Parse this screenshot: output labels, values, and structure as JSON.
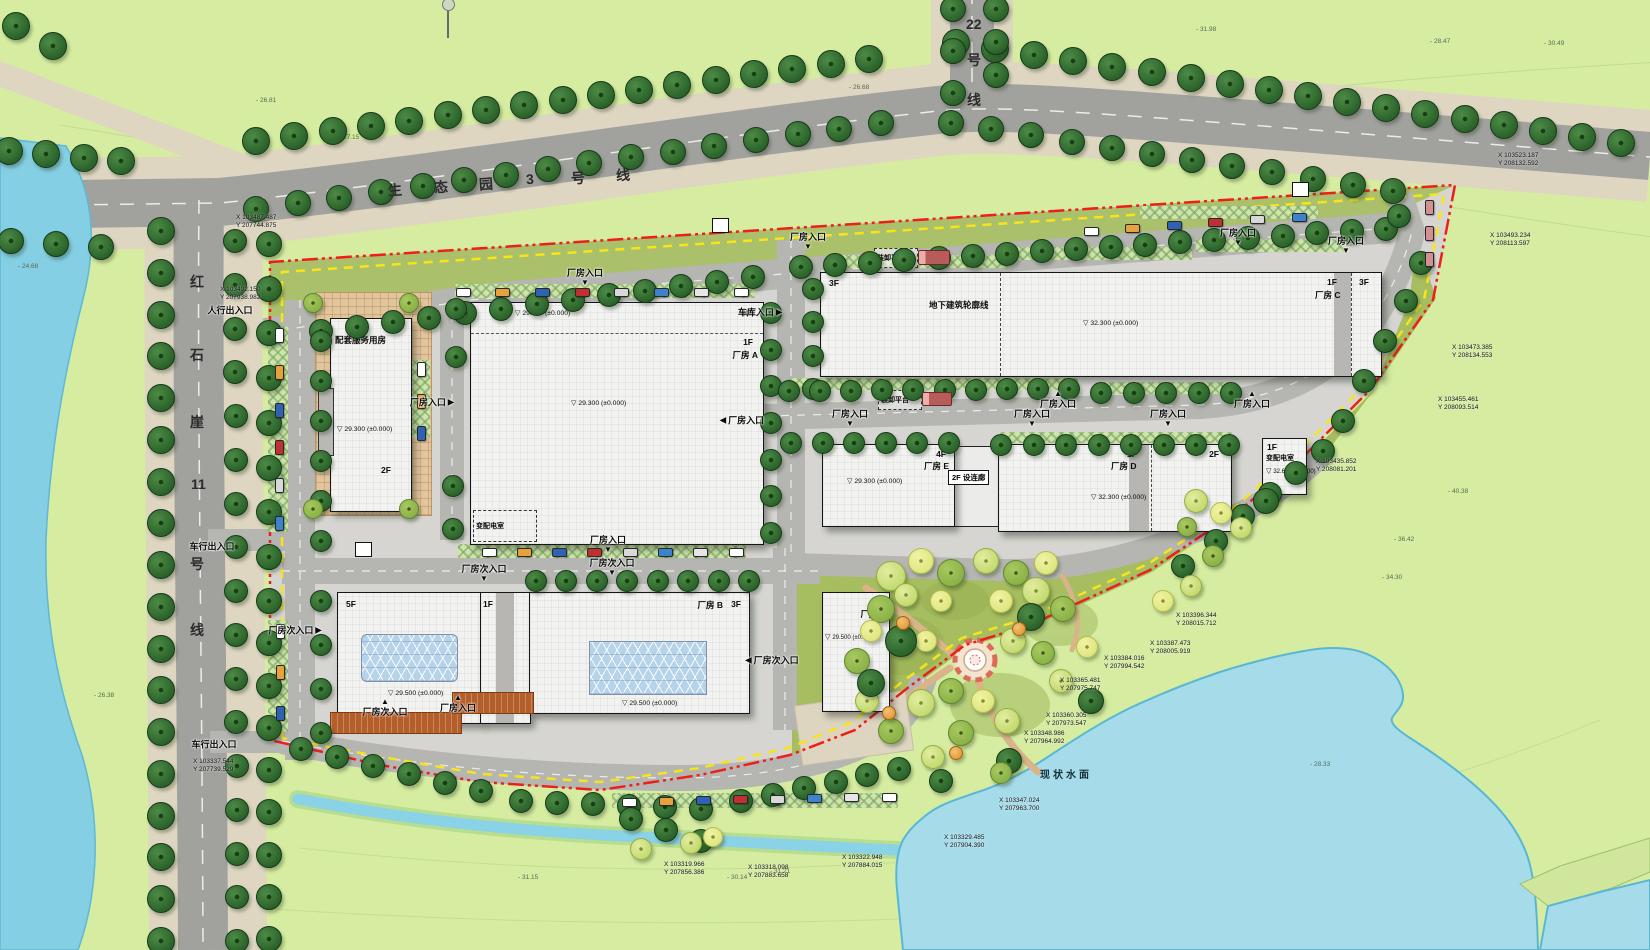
{
  "site": {
    "water_label": "现状水面",
    "water_pos": {
      "x": 1040,
      "y": 766
    }
  },
  "road_labels": {
    "eco_park_line3": {
      "text": "生态园3号线",
      "rotate": -4,
      "tokens": [
        {
          "c": "生",
          "x": 388,
          "y": 180
        },
        {
          "c": "态",
          "x": 434,
          "y": 177
        },
        {
          "c": "园",
          "x": 479,
          "y": 174
        },
        {
          "c": "3",
          "x": 526,
          "y": 171
        },
        {
          "c": "号",
          "x": 571,
          "y": 168
        },
        {
          "c": "线",
          "x": 616,
          "y": 165
        }
      ]
    },
    "line22": {
      "text": "22号线",
      "tokens": [
        {
          "c": "22",
          "x": 966,
          "y": 16
        },
        {
          "c": "号",
          "x": 967,
          "y": 50
        },
        {
          "c": "线",
          "x": 967,
          "y": 90
        }
      ]
    },
    "hongshiya_line11": {
      "text": "红石崖11号线",
      "tokens": [
        {
          "c": "红",
          "x": 190,
          "y": 272
        },
        {
          "c": "石",
          "x": 190,
          "y": 345
        },
        {
          "c": "崖",
          "x": 190,
          "y": 412
        },
        {
          "c": "11",
          "x": 191,
          "y": 476
        },
        {
          "c": "号",
          "x": 190,
          "y": 554
        },
        {
          "c": "线",
          "x": 190,
          "y": 620
        }
      ]
    }
  },
  "buildings": {
    "service": {
      "floors": "3F",
      "name": "配套服务用房",
      "elev": "29.300 (±0.000)",
      "floors2": "2F"
    },
    "a": {
      "elev_top": "29.300 (±0.000)",
      "floors": "3F",
      "floors_wing": "1F",
      "name": "厂房 A",
      "elev": "29.300 (±0.000)",
      "substation": "变配电室"
    },
    "c": {
      "floors_left": "3F",
      "underground": "地下建筑轮廓线",
      "elev": "32.300 (±0.000)",
      "floors_mid": "1F",
      "name": "厂房 C",
      "floors_right": "3F"
    },
    "e": {
      "floors": "4F",
      "name": "厂房 E",
      "elev": "29.300 (±0.000)"
    },
    "corridor": {
      "label": "2F 设连廊"
    },
    "d": {
      "floors": "1F",
      "name": "厂房 D",
      "floors2": "2F",
      "elev": "32.300 (±0.000)"
    },
    "sub_right": {
      "floors": "1F",
      "name": "变配电室",
      "elev": "32.600 (±0.000)"
    },
    "b5f": {
      "floors": "5F",
      "elev": "29.500 (±0.000)"
    },
    "b_wing": {
      "floors": "1F"
    },
    "b": {
      "name": "厂房 B",
      "floors": "3F",
      "elev": "29.500 (±0.000)"
    },
    "f": {
      "floors": "2F",
      "name": "厂房 F",
      "elev": "29.500 (±0.000)"
    }
  },
  "annotations": {
    "platform": "装卸平台"
  },
  "entrances": [
    {
      "t": "厂房入口",
      "d": "down",
      "x": 585,
      "y": 276
    },
    {
      "t": "厂房入口",
      "d": "right",
      "x": 432,
      "y": 402
    },
    {
      "t": "车库入口",
      "d": "right",
      "x": 760,
      "y": 312
    },
    {
      "t": "厂房入口",
      "d": "down",
      "x": 808,
      "y": 240
    },
    {
      "t": "厂房入口",
      "d": "down",
      "x": 1238,
      "y": 236
    },
    {
      "t": "厂房入口",
      "d": "down",
      "x": 1346,
      "y": 244
    },
    {
      "t": "厂房入口",
      "d": "left",
      "x": 742,
      "y": 420
    },
    {
      "t": "厂房入口",
      "d": "down",
      "x": 850,
      "y": 417
    },
    {
      "t": "厂房入口",
      "d": "up",
      "x": 1058,
      "y": 400
    },
    {
      "t": "厂房入口",
      "d": "down",
      "x": 1032,
      "y": 417
    },
    {
      "t": "厂房入口",
      "d": "down",
      "x": 1168,
      "y": 417
    },
    {
      "t": "厂房入口",
      "d": "up",
      "x": 1252,
      "y": 400
    },
    {
      "t": "厂房入口",
      "d": "down",
      "x": 608,
      "y": 543
    },
    {
      "t": "厂房次入口",
      "d": "down",
      "x": 484,
      "y": 572
    },
    {
      "t": "厂房次入口",
      "d": "down",
      "x": 612,
      "y": 566
    },
    {
      "t": "厂房次入口",
      "d": "right",
      "x": 295,
      "y": 630
    },
    {
      "t": "厂房次入口",
      "d": "left",
      "x": 772,
      "y": 660
    },
    {
      "t": "厂房次入口",
      "d": "up",
      "x": 385,
      "y": 708
    },
    {
      "t": "厂房入口",
      "d": "up",
      "x": 458,
      "y": 704
    },
    {
      "t": "人行出入口",
      "d": "none",
      "x": 230,
      "y": 310
    },
    {
      "t": "车行出入口",
      "d": "none",
      "x": 212,
      "y": 546
    },
    {
      "t": "车行出入口",
      "d": "none",
      "x": 214,
      "y": 744
    }
  ],
  "coordinates": [
    {
      "x": "103487.487",
      "y": "207744.875",
      "px": 236,
      "py": 214
    },
    {
      "x": "103492.150",
      "y": "207938.982",
      "px": 220,
      "py": 286
    },
    {
      "x": "103523.187",
      "y": "208132.592",
      "px": 1498,
      "py": 152
    },
    {
      "x": "103493.234",
      "y": "208113.597",
      "px": 1490,
      "py": 232
    },
    {
      "x": "103473.385",
      "y": "208134.553",
      "px": 1452,
      "py": 344
    },
    {
      "x": "103455.461",
      "y": "208093.514",
      "px": 1438,
      "py": 396
    },
    {
      "x": "103435.852",
      "y": "208081.201",
      "px": 1316,
      "py": 458
    },
    {
      "x": "103396.344",
      "y": "208015.712",
      "px": 1176,
      "py": 612
    },
    {
      "x": "103387.473",
      "y": "208005.919",
      "px": 1150,
      "py": 640
    },
    {
      "x": "103384.016",
      "y": "207994.542",
      "px": 1104,
      "py": 655
    },
    {
      "x": "103365.481",
      "y": "207975.747",
      "px": 1060,
      "py": 677
    },
    {
      "x": "103360.305",
      "y": "207973.547",
      "px": 1046,
      "py": 712
    },
    {
      "x": "103348.986",
      "y": "207964.992",
      "px": 1024,
      "py": 730
    },
    {
      "x": "103347.024",
      "y": "207963.700",
      "px": 999,
      "py": 797
    },
    {
      "x": "103329.485",
      "y": "207904.390",
      "px": 944,
      "py": 834
    },
    {
      "x": "103322.948",
      "y": "207884.015",
      "px": 842,
      "py": 854
    },
    {
      "x": "103318.098",
      "y": "207883.658",
      "px": 748,
      "py": 864
    },
    {
      "x": "103319.966",
      "y": "207856.386",
      "px": 664,
      "py": 861
    },
    {
      "x": "103337.544",
      "y": "207739.529",
      "px": 193,
      "py": 758
    }
  ],
  "spot_elevations": [
    {
      "t": "26.81",
      "x": 256,
      "y": 97
    },
    {
      "t": "27.15",
      "x": 339,
      "y": 134
    },
    {
      "t": "26.68",
      "x": 849,
      "y": 84
    },
    {
      "t": "31.98",
      "x": 1196,
      "y": 26
    },
    {
      "t": "28.47",
      "x": 1430,
      "y": 38
    },
    {
      "t": "30.49",
      "x": 1544,
      "y": 40
    },
    {
      "t": "24.68",
      "x": 18,
      "y": 263
    },
    {
      "t": "26.38",
      "x": 94,
      "y": 692
    },
    {
      "t": "28.33",
      "x": 1310,
      "y": 761
    },
    {
      "t": "31.21",
      "x": 770,
      "y": 868
    },
    {
      "t": "30.14",
      "x": 727,
      "y": 874
    },
    {
      "t": "31.15",
      "x": 518,
      "y": 874
    },
    {
      "t": "40.38",
      "x": 1448,
      "y": 488
    },
    {
      "t": "36.42",
      "x": 1394,
      "y": 536
    },
    {
      "t": "34.30",
      "x": 1382,
      "y": 574
    }
  ],
  "colors": {
    "boundary_red": "#ee1f1b",
    "boundary_yellow": "#f7e51c",
    "water": "#a6dcea",
    "river": "#84cfe3",
    "lawn": "#d5eca1",
    "garden": "#a6bd60",
    "road": "#a1a19e",
    "sidewalk": "#ded6c1",
    "building": "#f2f2f0"
  },
  "decor": {
    "tree_rows": [
      [
        8,
        150,
        120,
        160,
        4,
        13
      ],
      [
        10,
        240,
        100,
        246,
        3,
        12
      ],
      [
        255,
        140,
        868,
        58,
        17,
        13
      ],
      [
        955,
        42,
        1620,
        142,
        18,
        13
      ],
      [
        255,
        208,
        880,
        122,
        16,
        12
      ],
      [
        950,
        122,
        1392,
        190,
        12,
        12
      ],
      [
        952,
        8,
        952,
        92,
        3,
        12
      ],
      [
        995,
        8,
        995,
        74,
        3,
        12
      ],
      [
        160,
        230,
        160,
        940,
        18,
        13
      ],
      [
        234,
        240,
        236,
        940,
        17,
        11
      ],
      [
        268,
        243,
        268,
        556,
        8,
        12
      ],
      [
        268,
        600,
        268,
        938,
        9,
        12
      ],
      [
        320,
        330,
        752,
        276,
        13,
        11
      ],
      [
        800,
        266,
        1385,
        228,
        18,
        11
      ],
      [
        770,
        312,
        770,
        532,
        7,
        10
      ],
      [
        812,
        288,
        812,
        388,
        4,
        10
      ],
      [
        788,
        390,
        1068,
        388,
        10,
        10
      ],
      [
        1100,
        392,
        1230,
        392,
        5,
        10
      ],
      [
        790,
        442,
        948,
        442,
        6,
        10
      ],
      [
        1000,
        444,
        1228,
        444,
        8,
        10
      ],
      [
        535,
        580,
        748,
        580,
        8,
        10
      ],
      [
        320,
        340,
        320,
        540,
        6,
        10
      ],
      [
        320,
        600,
        320,
        732,
        4,
        10
      ],
      [
        300,
        748,
        480,
        790,
        6,
        11
      ],
      [
        520,
        800,
        700,
        808,
        6,
        11
      ],
      [
        740,
        800,
        898,
        768,
        6,
        11
      ],
      [
        1398,
        215,
        1420,
        262,
        2,
        11
      ],
      [
        1405,
        300,
        1342,
        420,
        4,
        11
      ],
      [
        1322,
        450,
        1242,
        515,
        4,
        11
      ],
      [
        1215,
        540,
        1182,
        565,
        2,
        11
      ],
      [
        452,
        485,
        452,
        528,
        2,
        10
      ],
      [
        455,
        308,
        455,
        356,
        2,
        10
      ],
      [
        630,
        818,
        700,
        840,
        3,
        11
      ],
      [
        15,
        25,
        52,
        45,
        2,
        13
      ]
    ],
    "tree_singles": [
      [
        890,
        575,
        14,
        "l"
      ],
      [
        920,
        560,
        12,
        "y"
      ],
      [
        950,
        572,
        13,
        "m"
      ],
      [
        985,
        560,
        12,
        "l"
      ],
      [
        1015,
        572,
        12,
        "m"
      ],
      [
        1045,
        562,
        11,
        "y"
      ],
      [
        880,
        608,
        13,
        "m"
      ],
      [
        905,
        594,
        11,
        "l"
      ],
      [
        1035,
        590,
        13,
        "l"
      ],
      [
        1062,
        608,
        12,
        "m"
      ],
      [
        940,
        600,
        10,
        "y"
      ],
      [
        1000,
        600,
        11,
        "y"
      ],
      [
        925,
        640,
        10,
        "y"
      ],
      [
        1012,
        640,
        12,
        "l"
      ],
      [
        1042,
        652,
        11,
        "m"
      ],
      [
        900,
        640,
        15,
        "d"
      ],
      [
        1030,
        616,
        13,
        "d"
      ],
      [
        950,
        690,
        12,
        "m"
      ],
      [
        920,
        702,
        13,
        "l"
      ],
      [
        982,
        700,
        11,
        "y"
      ],
      [
        1006,
        720,
        12,
        "l"
      ],
      [
        960,
        732,
        12,
        "m"
      ],
      [
        932,
        756,
        11,
        "l"
      ],
      [
        890,
        730,
        12,
        "m"
      ],
      [
        866,
        700,
        11,
        "l"
      ],
      [
        856,
        660,
        12,
        "m"
      ],
      [
        870,
        630,
        10,
        "y"
      ],
      [
        870,
        682,
        13,
        "d"
      ],
      [
        1060,
        680,
        11,
        "l"
      ],
      [
        1086,
        646,
        10,
        "y"
      ],
      [
        1090,
        700,
        12,
        "d"
      ],
      [
        1008,
        760,
        12,
        "d"
      ],
      [
        940,
        780,
        11,
        "d"
      ],
      [
        1000,
        772,
        10,
        "m"
      ],
      [
        902,
        622,
        6,
        "o"
      ],
      [
        1018,
        628,
        6,
        "o"
      ],
      [
        888,
        712,
        6,
        "o"
      ],
      [
        955,
        752,
        6,
        "o"
      ],
      [
        1195,
        500,
        11,
        "l"
      ],
      [
        1220,
        512,
        10,
        "y"
      ],
      [
        1186,
        526,
        9,
        "m"
      ],
      [
        1265,
        500,
        12,
        "d"
      ],
      [
        1240,
        527,
        10,
        "l"
      ],
      [
        1212,
        555,
        10,
        "m"
      ],
      [
        1190,
        585,
        10,
        "l"
      ],
      [
        1162,
        600,
        10,
        "y"
      ],
      [
        690,
        842,
        10,
        "l"
      ],
      [
        712,
        836,
        9,
        "y"
      ],
      [
        640,
        848,
        10,
        "l"
      ],
      [
        312,
        302,
        9,
        "m"
      ],
      [
        408,
        302,
        9,
        "m"
      ],
      [
        312,
        508,
        9,
        "m"
      ],
      [
        408,
        508,
        9,
        "m"
      ]
    ],
    "car_rows": [
      [
        462,
        291,
        740,
        291,
        8,
        "h"
      ],
      [
        1090,
        230,
        1298,
        216,
        6,
        "h"
      ],
      [
        1428,
        206,
        1428,
        258,
        3,
        "v",
        "#d49090"
      ],
      [
        278,
        334,
        278,
        522,
        6,
        "v"
      ],
      [
        279,
        630,
        279,
        712,
        3,
        "v"
      ],
      [
        488,
        551,
        735,
        551,
        8,
        "h"
      ],
      [
        628,
        801,
        888,
        796,
        8,
        "h"
      ],
      [
        420,
        368,
        420,
        432,
        3,
        "v"
      ]
    ],
    "checker_strips": [
      [
        455,
        284,
        300,
        14
      ],
      [
        458,
        544,
        288,
        14
      ],
      [
        268,
        326,
        20,
        206
      ],
      [
        268,
        620,
        20,
        112
      ],
      [
        828,
        255,
        180,
        13
      ],
      [
        1012,
        247,
        180,
        13
      ],
      [
        1196,
        239,
        150,
        13
      ],
      [
        788,
        378,
        290,
        12
      ],
      [
        1100,
        382,
        132,
        12
      ],
      [
        1000,
        432,
        232,
        11
      ],
      [
        612,
        793,
        286,
        15
      ],
      [
        1140,
        206,
        178,
        13
      ],
      [
        410,
        360,
        20,
        78
      ]
    ],
    "gates": [
      [
        712,
        218
      ],
      [
        1292,
        182
      ],
      [
        355,
        542
      ]
    ]
  }
}
